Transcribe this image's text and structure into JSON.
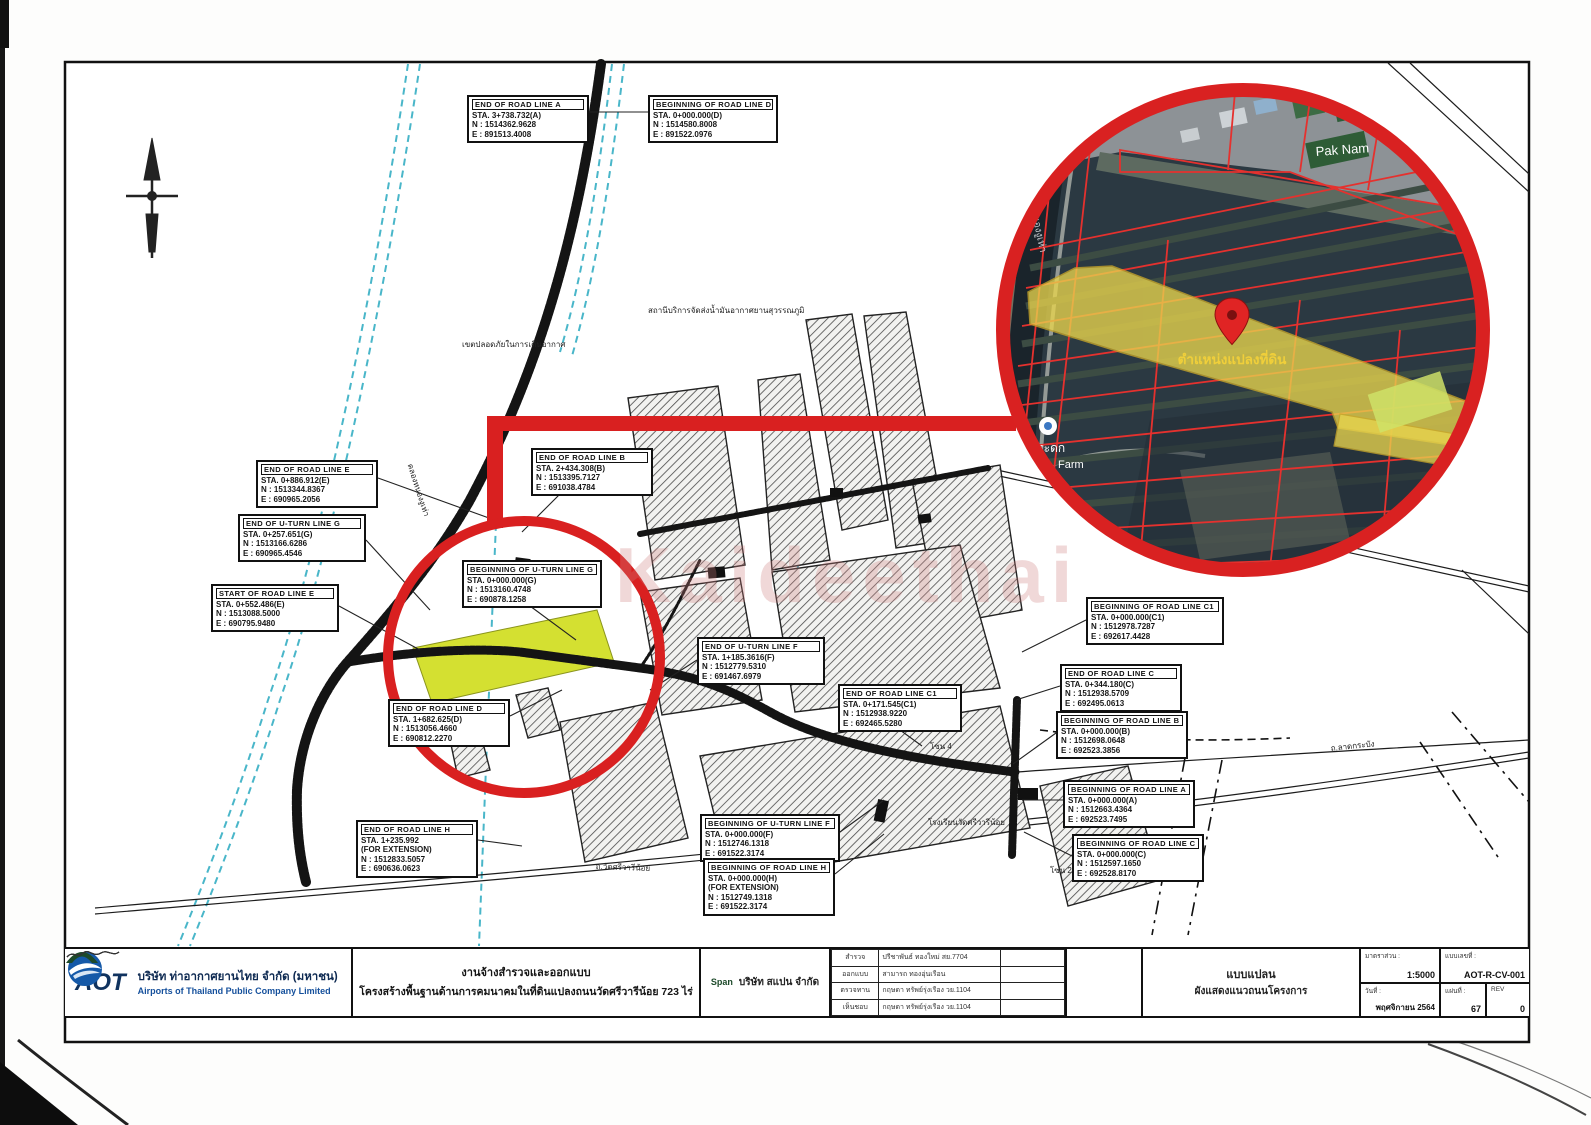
{
  "watermark": "Kaideethai",
  "labels": [
    {
      "title": "END OF ROAD LINE A",
      "lines": [
        "STA. 3+738.732(A)",
        "N : 1514362.9628",
        "E : 891513.4008"
      ],
      "x": 467,
      "y": 95,
      "w": 122
    },
    {
      "title": "BEGINNING OF ROAD LINE D",
      "lines": [
        "STA. 0+000.000(D)",
        "N : 1514580.8008",
        "E : 891522.0976"
      ],
      "x": 648,
      "y": 95,
      "w": 130
    },
    {
      "title": "END OF ROAD LINE E",
      "lines": [
        "STA. 0+886.912(E)",
        "N : 1513344.8367",
        "E : 690965.2056"
      ],
      "x": 256,
      "y": 460,
      "w": 122
    },
    {
      "title": "END OF ROAD LINE B",
      "lines": [
        "STA. 2+434.308(B)",
        "N : 1513395.7127",
        "E : 691038.4784"
      ],
      "x": 531,
      "y": 448,
      "w": 122
    },
    {
      "title": "END OF U-TURN LINE G",
      "lines": [
        "STA. 0+257.651(G)",
        "N : 1513166.6286",
        "E : 690965.4546"
      ],
      "x": 238,
      "y": 514,
      "w": 128
    },
    {
      "title": "START OF ROAD LINE E",
      "lines": [
        "STA. 0+552.486(E)",
        "N : 1513088.5000",
        "E : 690795.9480"
      ],
      "x": 211,
      "y": 584,
      "w": 128
    },
    {
      "title": "BEGINNING OF U-TURN LINE G",
      "lines": [
        "STA. 0+000.000(G)",
        "N : 1513160.4748",
        "E : 690878.1258"
      ],
      "x": 462,
      "y": 560,
      "w": 140
    },
    {
      "title": "END OF U-TURN LINE F",
      "lines": [
        "STA. 1+185.3616(F)",
        "N : 1512779.5310",
        "E : 691467.6979"
      ],
      "x": 697,
      "y": 637,
      "w": 128
    },
    {
      "title": "END OF ROAD LINE C1",
      "lines": [
        "STA. 0+171.545(C1)",
        "N : 1512938.9220",
        "E : 692465.5280"
      ],
      "x": 838,
      "y": 684,
      "w": 124
    },
    {
      "title": "BEGINNING OF ROAD LINE C1",
      "lines": [
        "STA. 0+000.000(C1)",
        "N : 1512978.7287",
        "E : 692617.4428"
      ],
      "x": 1086,
      "y": 597,
      "w": 138
    },
    {
      "title": "END OF ROAD LINE C",
      "lines": [
        "STA. 0+344.180(C)",
        "N : 1512938.5709",
        "E : 692495.0613"
      ],
      "x": 1060,
      "y": 664,
      "w": 122
    },
    {
      "title": "BEGINNING OF ROAD LINE B",
      "lines": [
        "STA. 0+000.000(B)",
        "N : 1512698.0648",
        "E : 692523.3856"
      ],
      "x": 1056,
      "y": 711,
      "w": 132
    },
    {
      "title": "BEGINNING OF ROAD LINE A",
      "lines": [
        "STA. 0+000.000(A)",
        "N : 1512663.4364",
        "E : 692523.7495"
      ],
      "x": 1063,
      "y": 780,
      "w": 132
    },
    {
      "title": "BEGINNING OF ROAD LINE C",
      "lines": [
        "STA. 0+000.000(C)",
        "N : 1512597.1650",
        "E : 692528.8170"
      ],
      "x": 1072,
      "y": 834,
      "w": 132
    },
    {
      "title": "END OF ROAD LINE D",
      "lines": [
        "STA. 1+682.625(D)",
        "N : 1513056.4660",
        "E : 690812.2270"
      ],
      "x": 388,
      "y": 699,
      "w": 122
    },
    {
      "title": "BEGINNING OF U-TURN LINE F",
      "lines": [
        "STA. 0+000.000(F)",
        "N : 1512746.1318",
        "E : 691522.3174"
      ],
      "x": 700,
      "y": 814,
      "w": 140
    },
    {
      "title": "BEGINNING OF ROAD LINE H",
      "lines": [
        "STA. 0+000.000(H)",
        "(FOR EXTENSION)",
        "N : 1512749.1318",
        "E : 691522.3174"
      ],
      "x": 703,
      "y": 858,
      "w": 132
    },
    {
      "title": "END OF ROAD LINE H",
      "lines": [
        "STA. 1+235.992",
        "(FOR EXTENSION)",
        "N : 1512833.5057",
        "E : 690636.0623"
      ],
      "x": 356,
      "y": 820,
      "w": 122
    }
  ],
  "map_texts": [
    {
      "text": "สถานีบริการจัดส่งน้ำมันอากาศยานสุวรรณภูมิ",
      "x": 648,
      "y": 304,
      "r": 0
    },
    {
      "text": "เขตปลอดภัยในการเดินอากาศ",
      "x": 462,
      "y": 338,
      "r": 0
    },
    {
      "text": "คลองหนองงูเห่า",
      "x": 416,
      "y": 462,
      "r": 72
    },
    {
      "text": "ถ.วัดศรีวารีน้อย",
      "x": 596,
      "y": 860,
      "r": 2
    },
    {
      "text": "โรงเรียนวัดศรีวารีน้อย",
      "x": 928,
      "y": 816,
      "r": 0
    },
    {
      "text": "ถ.ลาดกระบัง",
      "x": 1330,
      "y": 742,
      "r": -6
    },
    {
      "text": "โซน 4",
      "x": 930,
      "y": 740,
      "r": 0
    },
    {
      "text": "โซน 21",
      "x": 1050,
      "y": 864,
      "r": 0
    }
  ],
  "inset": {
    "place_label": "Pak Nam",
    "pin_label": "ตำแหน่งแปลงที่ดิน",
    "farm_line1": "ไม้กระดก",
    "farm_line2": "Farm",
    "canal_label": "คลองหนองงูเห่า"
  },
  "title_block": {
    "logo_text": "AOT",
    "company_th": "บริษัท ท่าอากาศยานไทย จำกัด (มหาชน)",
    "company_en": "Airports of Thailand Public Company Limited",
    "project_line1": "งานจ้างสำรวจและออกแบบ",
    "project_line2": "โครงสร้างพื้นฐานด้านการคมนาคมในที่ดินแปลงถนนวัดศรีวารีน้อย 723 ไร่",
    "consultant_logo": "Span",
    "consultant_name": "บริษัท สแปน จำกัด",
    "sign_rows": [
      {
        "role": "สำรวจ",
        "name": "ปรีชาพันธ์ ทองใหม่ สย.7704"
      },
      {
        "role": "ออกแบบ",
        "name": "สามารถ ทองอุ่นเรือน"
      },
      {
        "role": "ตรวจทาน",
        "name": "กฤษดา ทรัพย์รุ่งเรือง วย.1104"
      },
      {
        "role": "เห็นชอบ",
        "name": "กฤษดา ทรัพย์รุ่งเรือง วย.1104"
      }
    ],
    "drawing_title_line1": "แบบแปลน",
    "drawing_title_line2": "ผังแสดงแนวถนนโครงการ",
    "scale_label": "มาตราส่วน :",
    "scale_value": "1:5000",
    "dwg_no_label": "แบบเลขที่ :",
    "dwg_no_value": "AOT-R-CV-001",
    "date_label": "วันที่ :",
    "date_value": "พฤศจิกายน 2564",
    "sheet_label": "แผ่นที่ :",
    "sheet_value": "67",
    "rev_label": "REV",
    "rev_value": "0"
  }
}
